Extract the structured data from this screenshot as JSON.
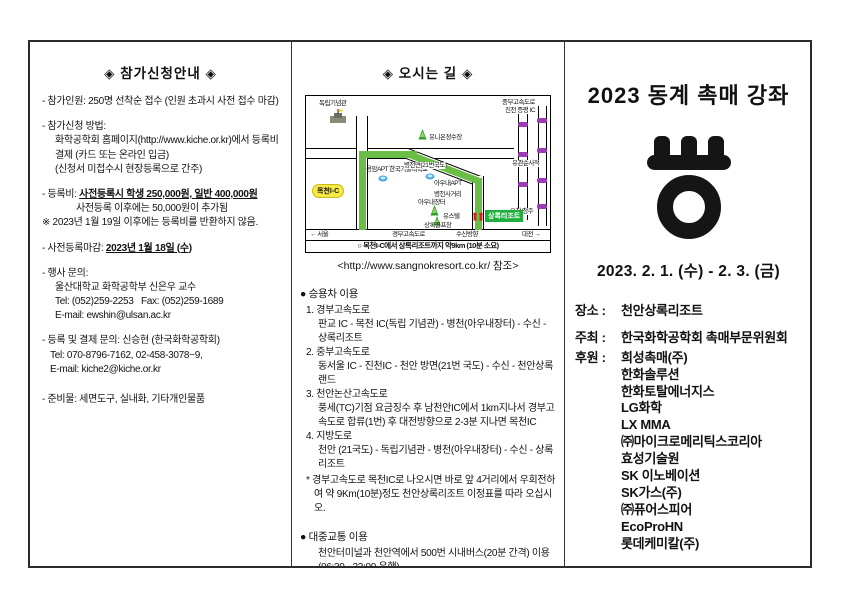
{
  "colors": {
    "route_green": "#6abe45",
    "marker_purple": "#9b3bb5",
    "resort_green": "#1faf3c",
    "ic_yellow": "#f7e943"
  },
  "left_column": {
    "title": "◈ 참가신청안내 ◈",
    "item1": "- 참가인원: 250명 선착순 접수 (인원 초과시 사전 접수 마감)",
    "item2_l1": "- 참가신청 방법:",
    "item2_l2": "화학공학회 홈페이지(http://www.kiche.or.kr)에서 등록비",
    "item2_l3": "결제 (카드 또는 온라인 입금)",
    "item2_l4": "(신청서 미접수시 현장등록으로 간주)",
    "item3_l1_prefix": "- 등록비: ",
    "item3_l1_underlined": "사전등록시 학생 250,000원, 일반 400,000원",
    "item3_l2": "사전등록 이후에는 50,000원이 추가됨",
    "item3_l3": "※ 2023년 1월 19일 이후에는 등록비를 반환하지 않음.",
    "item4_prefix": "- 사전등록마감: ",
    "item4_underlined": "2023년 1월 18일 (수)",
    "item5_l1": "- 행사 문의:",
    "item5_l2": "울산대학교 화학공학부 신은우 교수",
    "item5_l3": "Tel: (052)259-2253   Fax: (052)259-1689",
    "item5_l4": "E-mail: ewshin@ulsan.ac.kr",
    "item6_l1": "- 등록 및 결제 문의: 신승현 (한국화학공학회)",
    "item6_l2": "Tel: 070-8796-7162, 02-458-3078~9,",
    "item6_l3": "E-mail: kiche2@kiche.or.kr",
    "item7": "- 준비물: 세면도구, 실내화, 기타개인물품"
  },
  "middle_column": {
    "title": "◈ 오시는 길 ◈",
    "map": {
      "labels": {
        "independence_hall": "독립기념관",
        "mokcheon_ic": "목천I-C",
        "apt_school": "용암APT 한국기술대학교",
        "water_plant": "유니온정수장",
        "route21": "병천면(21번국도)",
        "aunae_apt": "아우내APT",
        "byeongcheon_junction": "병천사거리",
        "aunae_market": "아우내장터",
        "youstel": "유스텔",
        "golf": "상록골프장",
        "resort": "상록리조트",
        "susin": "수신방향",
        "seoul": "← 서울",
        "gyeongbu": "경부고속도로",
        "daejeon": "대전 →",
        "jungbu_ic_l1": "중부고속도로",
        "jungbu_ic_l2": "진천 증평 IC",
        "yugwansun": "유관순사적",
        "ochang": "오창/청주"
      },
      "caption": "○ 목천I-C에서 상록리조트까지 약9km (10분 소요)"
    },
    "url_line": "<http://www.sangnokresort.co.kr/ 참조>",
    "car_header": "● 승용차 이용",
    "car1_t": "1. 경부고속도로",
    "car1_d": "판교 IC - 목천 IC(독립 기념관) - 병천(아우내장터) - 수신 - 상록리조트",
    "car2_t": "2. 중부고속도로",
    "car2_d": "동서울 IC - 진천IC - 천안 방면(21번 국도) - 수신 - 천안상록랜드",
    "car3_t": "3. 천안논산고속도로",
    "car3_d": "풍세(TC)기점 요금징수 후 남천안IC에서 1km지나서 경부고속도로 합류(1번) 후 대전방향으로 2-3분 지나면 목천IC",
    "car4_t": "4. 지방도로",
    "car4_d": "천안 (21국도) - 독립기념관 - 병천(아우내장터) - 수신 - 상록리조트",
    "car_note": "* 경부고속도로 목천IC로 나오시면 바로 앞 4거리에서 우회전하여 약 9Km(10분)정도 천안상록리조트 이정표를 따라 오십시오.",
    "transit_header": "● 대중교통 이용",
    "transit_d": "천안터미널과 천안역에서 500번 시내버스(20분 간격) 이용 (06:30 - 22:00 운행)"
  },
  "right_column": {
    "title": "2023 동계 촉매 강좌",
    "date": "2023. 2. 1. (수) - 2. 3. (금)",
    "venue_label": "장소 :",
    "venue": "천안상록리조트",
    "host_label": "주최 :",
    "host": "한국화학공학회 촉매부문위원회",
    "sponsor_label": "후원 :",
    "sponsors": [
      "희성촉매(주)",
      "한화솔루션",
      "한화토탈에너지스",
      "LG화학",
      "LX MMA",
      "㈜마이크로메리틱스코리아",
      "효성기술원",
      "SK 이노베이션",
      "SK가스(주)",
      "㈜퓨어스피어",
      "EcoProHN",
      "롯데케미칼(주)"
    ]
  }
}
